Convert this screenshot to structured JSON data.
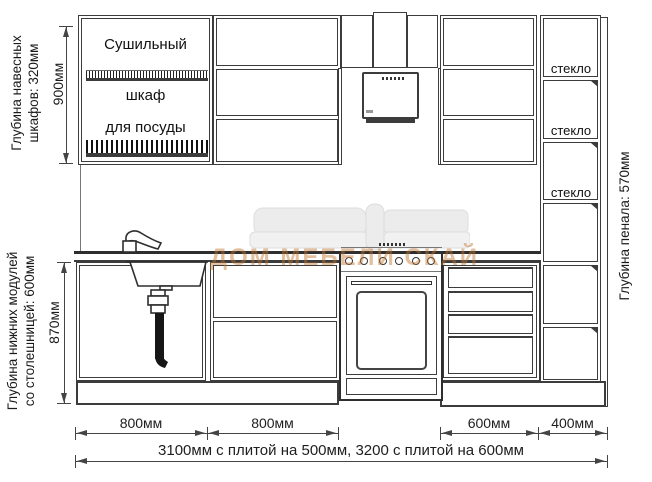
{
  "annotations": {
    "wall_cabinet_depth": [
      "Глубина навесных",
      "шкафов: 320мм"
    ],
    "wall_cabinet_height": "900мм",
    "base_cabinet_depth": [
      "Глубина нижних модулей",
      "со столешницей: 600мм"
    ],
    "base_cabinet_height": "870мм",
    "tall_cabinet_depth": "Глубина пенала: 570мм"
  },
  "cabinet_labels": {
    "drying_cabinet": [
      "Сушильный",
      "шкаф",
      "для посуды"
    ],
    "glass_shelves": [
      "стекло",
      "стекло",
      "стекло"
    ]
  },
  "dimensions": {
    "segments": [
      "800мм",
      "800мм",
      "600мм",
      "400мм"
    ],
    "total": "3100мм с плитой на 500мм, 3200 с плитой на 600мм"
  },
  "watermark": {
    "text": "ДОМ МЕБЕЛИ СКАЙ"
  },
  "colors": {
    "line": "#3c3c3c",
    "watermark": "#c0742e"
  }
}
